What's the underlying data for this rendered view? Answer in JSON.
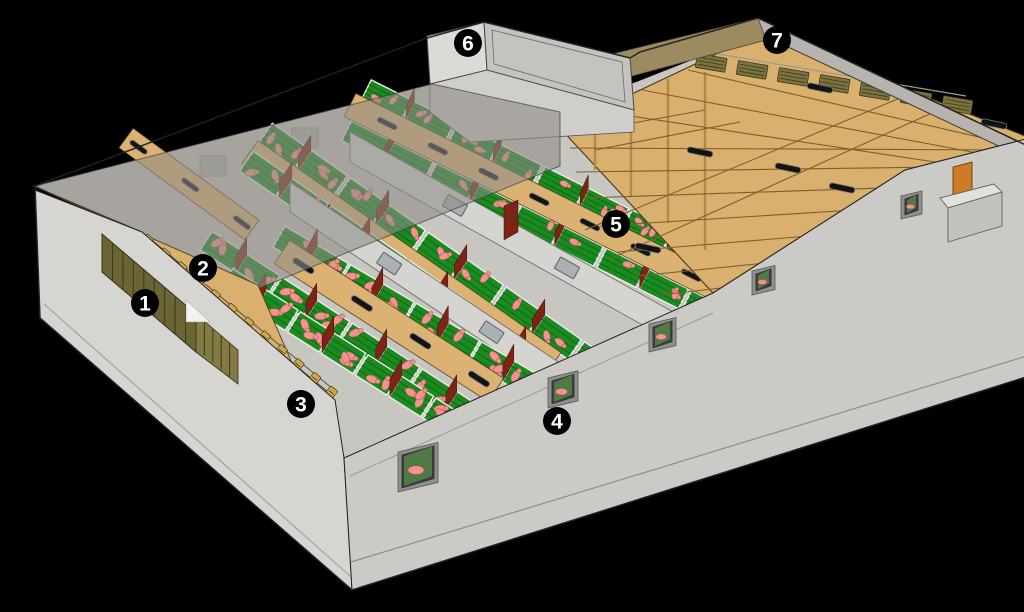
{
  "figure": {
    "kind": "3d-cutaway-illustration",
    "subject": "pig-barn-cross-section",
    "background": "#000000"
  },
  "markers": [
    {
      "id": "marker-1",
      "label": "1",
      "x": 145,
      "y": 303
    },
    {
      "id": "marker-2",
      "label": "2",
      "x": 203,
      "y": 268
    },
    {
      "id": "marker-3",
      "label": "3",
      "x": 301,
      "y": 404
    },
    {
      "id": "marker-4",
      "label": "4",
      "x": 557,
      "y": 421
    },
    {
      "id": "marker-5",
      "label": "5",
      "x": 616,
      "y": 224
    },
    {
      "id": "marker-6",
      "label": "6",
      "x": 468,
      "y": 43
    },
    {
      "id": "marker-7",
      "label": "7",
      "x": 777,
      "y": 40
    }
  ],
  "marker_style": {
    "radius": 14,
    "font_size": 21,
    "fill": "#000000",
    "text_color": "#ffffff"
  },
  "palette": {
    "background": "#000000",
    "concrete_light": "#d6d5d2",
    "concrete_mid": "#cbcac6",
    "interior_base": "#c8c6c1",
    "roof_translucent": "#8f8c86",
    "wood_floor": "#d9b06e",
    "walkway_tan": "#dcb273",
    "wood_truss": "#7d6028",
    "truss_light": "#b08a46",
    "louvre_dark": "#6b6535",
    "louvre_light": "#837b42",
    "attic_louvre": "#7a7340",
    "pen_green": "#1b8b20",
    "pen_slat": "#0d5f12",
    "fence_white": "#ececec",
    "pig_pink": "#f2938f",
    "pig_outline": "#a9524e",
    "maroon": "#7c2415",
    "door_orange": "#cd7b24",
    "vent_black": "#131313",
    "vent_rim": "#777777",
    "window_frame": "#8f8f8f",
    "window_dark": "#3a3a3a",
    "window_glass": "#4e7a44",
    "marker_bg": "#000000",
    "marker_text": "#ffffff",
    "outline": "#222222"
  }
}
